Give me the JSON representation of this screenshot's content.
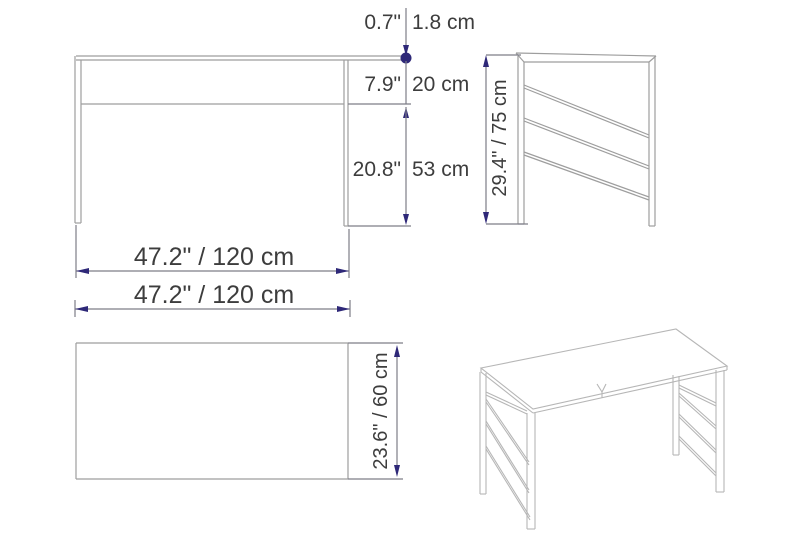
{
  "diagram": {
    "title": "desk-dimension-drawing",
    "front_view": {
      "top_thickness": {
        "inches": "0.7\"",
        "cm": "1.8 cm"
      },
      "apron_height": {
        "inches": "7.9\"",
        "cm": "20 cm"
      },
      "leg_clearance": {
        "inches": "20.8\"",
        "cm": "53 cm"
      },
      "width": "47.2\" / 120 cm"
    },
    "side_view": {
      "height": "29.4\" / 75 cm"
    },
    "top_view": {
      "width": "47.2\" / 120 cm",
      "depth": "23.6\" / 60 cm"
    },
    "colors": {
      "dimension_line": "#7d7d87",
      "accent": "#2e2878",
      "text": "#3d3d3d",
      "furniture_line": "#9e9e9e",
      "perspective_line": "#b6b6b6"
    }
  }
}
